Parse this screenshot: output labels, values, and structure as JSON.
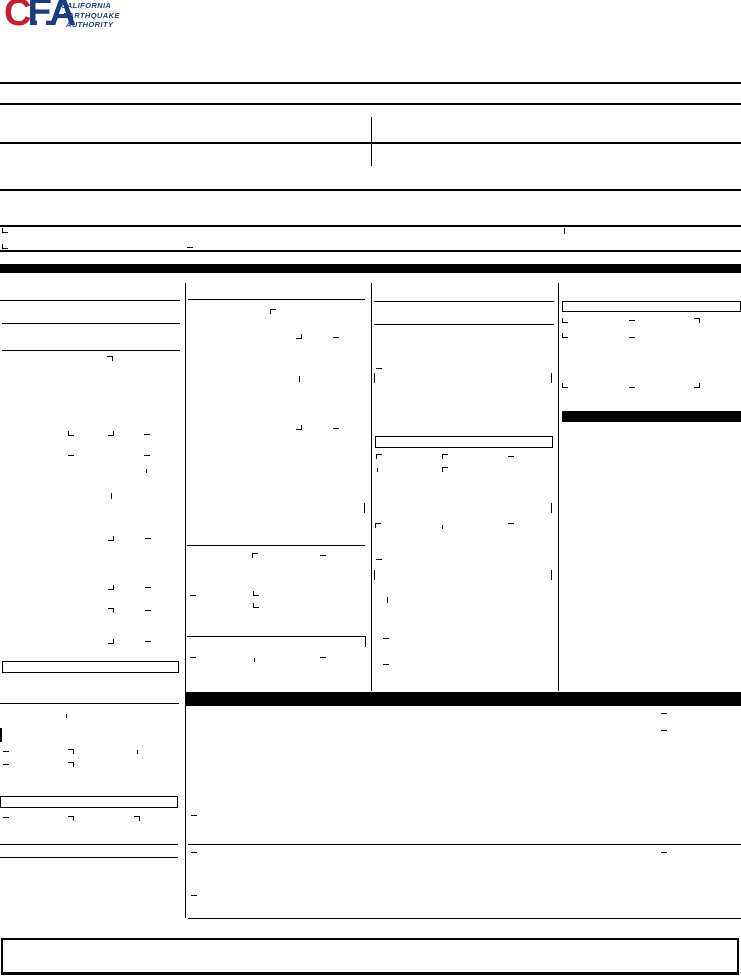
{
  "logo": {
    "monogram": [
      {
        "letter": "C",
        "color": "#c41f2e"
      },
      {
        "letter": "E",
        "color": "#1d3c7d"
      },
      {
        "letter": "A",
        "color": "#1d3c7d"
      }
    ],
    "tagline_lines": [
      "CALIFORNIA",
      "EARTHQUAKE",
      "AUTHORITY"
    ],
    "tagline_color": "#1d3c7d",
    "house_icon": "house-icon"
  },
  "geometry": {
    "line_color": "#000000",
    "hlines": [
      [
        0,
        82,
        741,
        2
      ],
      [
        0,
        103,
        741,
        2
      ],
      [
        0,
        142,
        741,
        2
      ],
      [
        0,
        189,
        741,
        2
      ],
      [
        0,
        225,
        741,
        2
      ],
      [
        0,
        250,
        741,
        2
      ],
      [
        0,
        300,
        180,
        1
      ],
      [
        2,
        323,
        178,
        1
      ],
      [
        2,
        350,
        178,
        1
      ],
      [
        188,
        299,
        177,
        1
      ],
      [
        374,
        301,
        180,
        1
      ],
      [
        374,
        324,
        180,
        1
      ],
      [
        187,
        545,
        178,
        1
      ],
      [
        187,
        636,
        178,
        1
      ],
      [
        0,
        703,
        179,
        1
      ],
      [
        0,
        844,
        178,
        1
      ],
      [
        0,
        857,
        178,
        1
      ],
      [
        188,
        844,
        553,
        1
      ],
      [
        188,
        918,
        553,
        1
      ]
    ],
    "vlines": [
      [
        371,
        117,
        49
      ],
      [
        185,
        283,
        635
      ],
      [
        371,
        283,
        408
      ],
      [
        558,
        283,
        408
      ],
      [
        365,
        636,
        11
      ]
    ],
    "bars": [
      [
        0,
        264,
        741,
        9
      ],
      [
        562,
        411,
        179,
        11
      ],
      [
        185,
        692,
        556,
        14
      ]
    ],
    "boxes": [
      [
        562,
        301,
        179,
        11,
        "thin"
      ],
      [
        375,
        436,
        178,
        12,
        "thin"
      ],
      [
        2,
        661,
        177,
        12,
        "thin"
      ],
      [
        0,
        796,
        178,
        12,
        "thin"
      ],
      [
        1,
        938,
        738,
        37,
        "thick"
      ]
    ],
    "marks": [
      [
        2,
        228,
        "cbl"
      ],
      [
        564,
        228,
        "vt"
      ],
      [
        2,
        244,
        "cbl"
      ],
      [
        187,
        247,
        "dash"
      ],
      [
        107,
        356,
        "ctr"
      ],
      [
        68,
        431,
        "cbl"
      ],
      [
        108,
        431,
        "cbr"
      ],
      [
        144,
        434,
        "dash"
      ],
      [
        68,
        455,
        "dash"
      ],
      [
        144,
        455,
        "dash"
      ],
      [
        146,
        469,
        "vts"
      ],
      [
        111,
        493,
        "vt"
      ],
      [
        108,
        536,
        "cbr"
      ],
      [
        145,
        538,
        "dash"
      ],
      [
        108,
        585,
        "cbr"
      ],
      [
        145,
        587,
        "dash"
      ],
      [
        108,
        608,
        "ctr"
      ],
      [
        145,
        610,
        "dash"
      ],
      [
        108,
        639,
        "cbr"
      ],
      [
        145,
        641,
        "dash"
      ],
      [
        66,
        714,
        "vts"
      ],
      [
        0,
        728,
        "vbar"
      ],
      [
        3,
        751,
        "dash"
      ],
      [
        68,
        749,
        "ctr"
      ],
      [
        137,
        750,
        "vts"
      ],
      [
        3,
        764,
        "dash"
      ],
      [
        68,
        762,
        "ctr"
      ],
      [
        3,
        817,
        "dash"
      ],
      [
        68,
        816,
        "ctr"
      ],
      [
        134,
        816,
        "ctr"
      ],
      [
        270,
        309,
        "ctl"
      ],
      [
        296,
        334,
        "cbr"
      ],
      [
        333,
        337,
        "dash"
      ],
      [
        299,
        376,
        "vt"
      ],
      [
        296,
        425,
        "cbr"
      ],
      [
        333,
        428,
        "dash"
      ],
      [
        364,
        503,
        "vtl"
      ],
      [
        252,
        553,
        "ctl"
      ],
      [
        320,
        555,
        "dash"
      ],
      [
        190,
        595,
        "dash"
      ],
      [
        253,
        591,
        "cbl"
      ],
      [
        253,
        603,
        "cbl"
      ],
      [
        190,
        657,
        "dash"
      ],
      [
        254,
        658,
        "vts"
      ],
      [
        320,
        657,
        "dash"
      ],
      [
        376,
        368,
        "dash"
      ],
      [
        374,
        373,
        "vtl"
      ],
      [
        551,
        373,
        "vtl"
      ],
      [
        376,
        454,
        "ctl"
      ],
      [
        442,
        454,
        "ctl"
      ],
      [
        508,
        456,
        "dash"
      ],
      [
        377,
        468,
        "vts"
      ],
      [
        442,
        467,
        "ctl"
      ],
      [
        551,
        503,
        "vtl"
      ],
      [
        375,
        523,
        "ctl"
      ],
      [
        442,
        525,
        "vts"
      ],
      [
        508,
        523,
        "dash"
      ],
      [
        376,
        559,
        "dash"
      ],
      [
        374,
        570,
        "vtl"
      ],
      [
        551,
        570,
        "vtl"
      ],
      [
        387,
        597,
        "vt"
      ],
      [
        383,
        638,
        "dash"
      ],
      [
        383,
        664,
        "dash"
      ],
      [
        562,
        318,
        "cbl"
      ],
      [
        629,
        320,
        "dash"
      ],
      [
        694,
        318,
        "ctr"
      ],
      [
        562,
        333,
        "cbl"
      ],
      [
        629,
        337,
        "dash"
      ],
      [
        562,
        383,
        "cbl"
      ],
      [
        629,
        387,
        "dash"
      ],
      [
        694,
        383,
        "cbr"
      ],
      [
        661,
        713,
        "dash"
      ],
      [
        661,
        730,
        "dash"
      ],
      [
        191,
        815,
        "dash"
      ],
      [
        191,
        852,
        "dash"
      ],
      [
        661,
        852,
        "dash"
      ],
      [
        191,
        895,
        "dash"
      ]
    ]
  }
}
